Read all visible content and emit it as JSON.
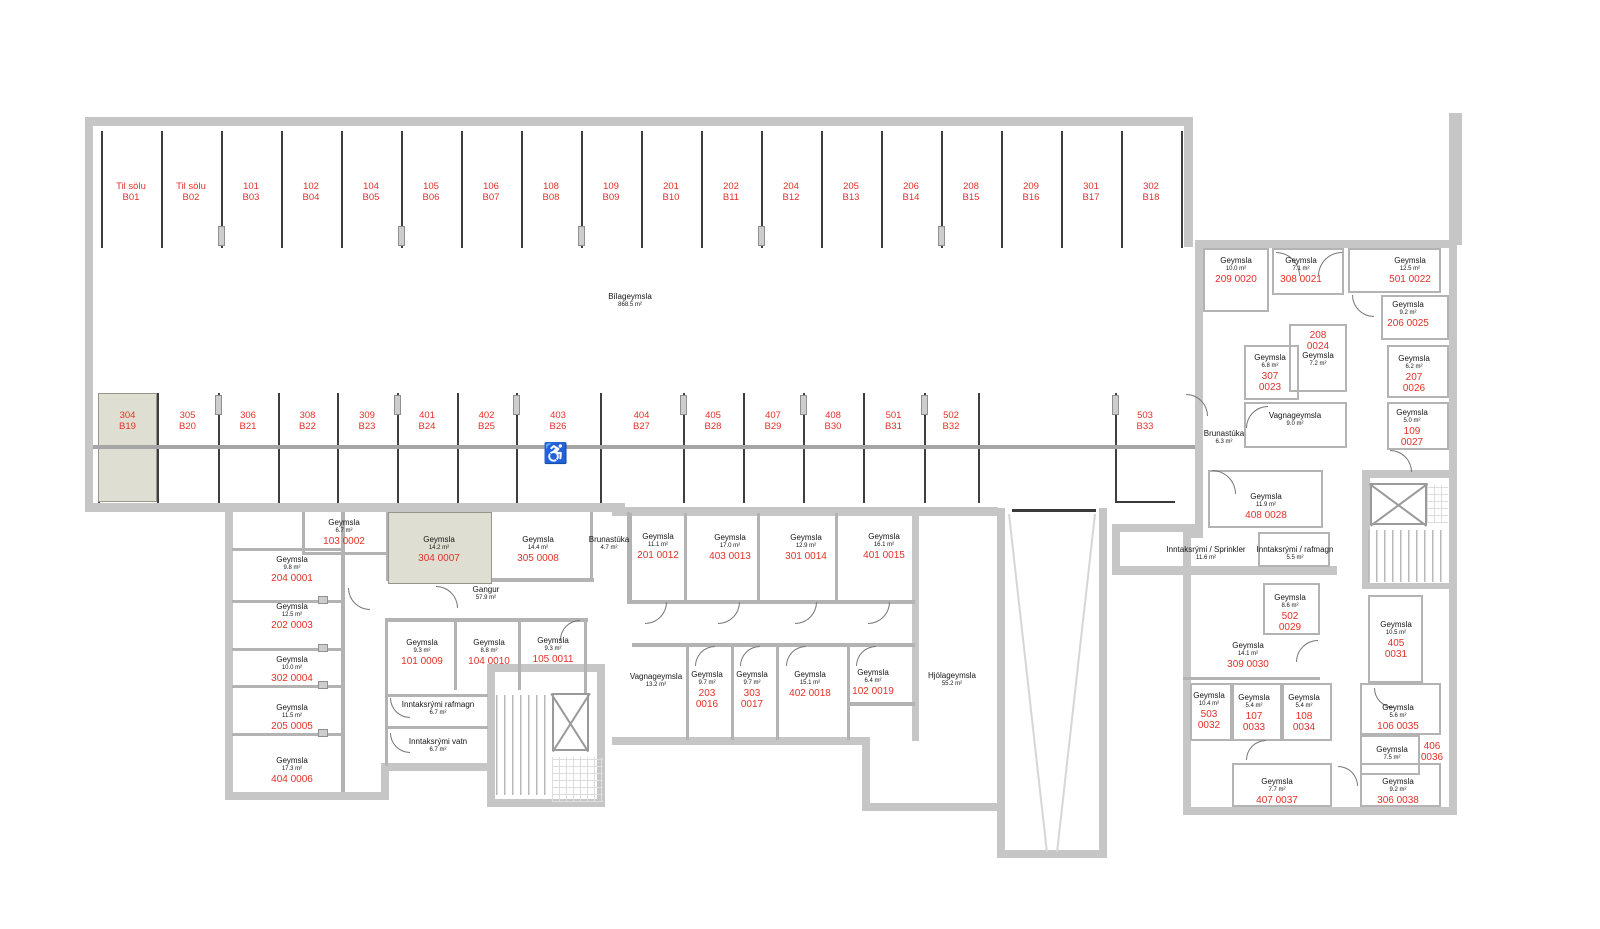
{
  "colors": {
    "red": "#e23128",
    "wall": "#c6c6c6",
    "thin_wall": "#b3b3b3",
    "highlight": "#dedfd2",
    "divider": "#3e3e3e"
  },
  "garage": {
    "name": "Bílageymsla",
    "area": "868.5 m²"
  },
  "icons": {
    "wheelchair": "♿"
  },
  "parking_top": [
    {
      "l1": "Til sölu",
      "l2": "B01"
    },
    {
      "l1": "Til sölu",
      "l2": "B02"
    },
    {
      "l1": "101",
      "l2": "B03"
    },
    {
      "l1": "102",
      "l2": "B04"
    },
    {
      "l1": "104",
      "l2": "B05"
    },
    {
      "l1": "105",
      "l2": "B06"
    },
    {
      "l1": "106",
      "l2": "B07"
    },
    {
      "l1": "108",
      "l2": "B08"
    },
    {
      "l1": "109",
      "l2": "B09"
    },
    {
      "l1": "201",
      "l2": "B10"
    },
    {
      "l1": "202",
      "l2": "B11"
    },
    {
      "l1": "204",
      "l2": "B12"
    },
    {
      "l1": "205",
      "l2": "B13"
    },
    {
      "l1": "206",
      "l2": "B14"
    },
    {
      "l1": "208",
      "l2": "B15"
    },
    {
      "l1": "209",
      "l2": "B16"
    },
    {
      "l1": "301",
      "l2": "B17"
    },
    {
      "l1": "302",
      "l2": "B18"
    }
  ],
  "parking_mid": [
    {
      "l1": "304",
      "l2": "B19",
      "highlight": true
    },
    {
      "l1": "305",
      "l2": "B20"
    },
    {
      "l1": "306",
      "l2": "B21"
    },
    {
      "l1": "308",
      "l2": "B22"
    },
    {
      "l1": "309",
      "l2": "B23"
    },
    {
      "l1": "401",
      "l2": "B24"
    },
    {
      "l1": "402",
      "l2": "B25"
    },
    {
      "l1": "403",
      "l2": "B26"
    },
    {
      "l1": "404",
      "l2": "B27"
    },
    {
      "l1": "405",
      "l2": "B28"
    },
    {
      "l1": "407",
      "l2": "B29"
    },
    {
      "l1": "408",
      "l2": "B30"
    },
    {
      "l1": "501",
      "l2": "B31"
    },
    {
      "l1": "502",
      "l2": "B32"
    },
    {
      "l1": "503",
      "l2": "B33"
    }
  ],
  "rooms": [
    {
      "name": "Geymsla",
      "area": "9.8 m²",
      "unit": "204 0001"
    },
    {
      "name": "Geymsla",
      "area": "12.5 m²",
      "unit": "202 0003"
    },
    {
      "name": "Geymsla",
      "area": "6.7 m²",
      "unit": "103 0002"
    },
    {
      "name": "Geymsla",
      "area": "14.2 m²",
      "unit": "304 0007",
      "highlight": true
    },
    {
      "name": "Geymsla",
      "area": "14.4 m²",
      "unit": "305 0008"
    },
    {
      "name": "Brunastúka",
      "area": "4.7 m²"
    },
    {
      "name": "Gangur",
      "area": "57.9 m²"
    },
    {
      "name": "Geymsla",
      "area": "10.0 m²",
      "unit": "302 0004"
    },
    {
      "name": "Geymsla",
      "area": "11.5 m²",
      "unit": "205 0005"
    },
    {
      "name": "Geymsla",
      "area": "17.3 m²",
      "unit": "404 0006"
    },
    {
      "name": "Geymsla",
      "area": "9.3 m²",
      "unit": "101 0009"
    },
    {
      "name": "Geymsla",
      "area": "8.8 m²",
      "unit": "104 0010"
    },
    {
      "name": "Geymsla",
      "area": "9.3 m²",
      "unit": "105 0011"
    },
    {
      "name": "Inntaksrými rafmagn",
      "area": "6.7 m²"
    },
    {
      "name": "Inntaksrými vatn",
      "area": "6.7 m²"
    },
    {
      "name": "Geymsla",
      "area": "11.1 m²",
      "unit": "201 0012"
    },
    {
      "name": "Geymsla",
      "area": "17.0 m²",
      "unit": "403 0013"
    },
    {
      "name": "Geymsla",
      "area": "12.9 m²",
      "unit": "301 0014"
    },
    {
      "name": "Geymsla",
      "area": "16.1 m²",
      "unit": "401 0015"
    },
    {
      "name": "Vagnageymsla",
      "area": "13.2 m²"
    },
    {
      "name": "Geymsla",
      "area": "9.7 m²",
      "unit2": [
        "203",
        "0016"
      ]
    },
    {
      "name": "Geymsla",
      "area": "9.7 m²",
      "unit2": [
        "303",
        "0017"
      ]
    },
    {
      "name": "Geymsla",
      "area": "15.1 m²",
      "unit": "402 0018"
    },
    {
      "name": "Geymsla",
      "area": "6.4 m²",
      "unit": "102 0019"
    },
    {
      "name": "Hjólageymsla",
      "area": "55.2 m²"
    },
    {
      "name": "Geymsla",
      "area": "10.0 m²",
      "unit": "209 0020"
    },
    {
      "name": "Geymsla",
      "area": "7.1 m²",
      "unit": "308 0021"
    },
    {
      "name": "Geymsla",
      "area": "12.5 m²",
      "unit": "501 0022"
    },
    {
      "name": "Geymsla",
      "area": "9.2 m²",
      "unit": "206 0025"
    },
    {
      "name": "Geymsla",
      "area": "7.2 m²",
      "unit2": [
        "208",
        "0024"
      ]
    },
    {
      "name": "Geymsla",
      "area": "6.8 m²",
      "unit2": [
        "307",
        "0023"
      ]
    },
    {
      "name": "Geymsla",
      "area": "6.2 m²",
      "unit2": [
        "207",
        "0026"
      ]
    },
    {
      "name": "Vagnageymsla",
      "area": "9.0 m²"
    },
    {
      "name": "Geymsla",
      "area": "5.0 m²",
      "unit2": [
        "109",
        "0027"
      ]
    },
    {
      "name": "Brunastúka",
      "area": "6.3 m²"
    },
    {
      "name": "Geymsla",
      "area": "11.9 m²",
      "unit": "408 0028"
    },
    {
      "name": "Inntaksrými / Sprinkler",
      "area": "11.6 m²"
    },
    {
      "name": "Inntaksrými / rafmagn",
      "area": "5.5 m²"
    },
    {
      "name": "Geymsla",
      "area": "8.6 m²",
      "unit2": [
        "502",
        "0029"
      ]
    },
    {
      "name": "Geymsla",
      "area": "14.1 m²",
      "unit": "309 0030"
    },
    {
      "name": "Geymsla",
      "area": "10.5 m²",
      "unit2": [
        "405",
        "0031"
      ]
    },
    {
      "name": "Geymsla",
      "area": "10.4 m²",
      "unit2": [
        "503",
        "0032"
      ]
    },
    {
      "name": "Geymsla",
      "area": "5.4 m²",
      "unit2": [
        "107",
        "0033"
      ]
    },
    {
      "name": "Geymsla",
      "area": "5.4 m²",
      "unit2": [
        "108",
        "0034"
      ]
    },
    {
      "name": "Geymsla",
      "area": "5.6 m²",
      "unit": "106 0035"
    },
    {
      "name": "Geymsla",
      "area": "7.5 m²",
      "unit2": [
        "406",
        "0036"
      ],
      "unit_side": true
    },
    {
      "name": "Geymsla",
      "area": "7.7 m²",
      "unit": "407 0037"
    },
    {
      "name": "Geymsla",
      "area": "9.2 m²",
      "unit": "306 0038"
    }
  ]
}
